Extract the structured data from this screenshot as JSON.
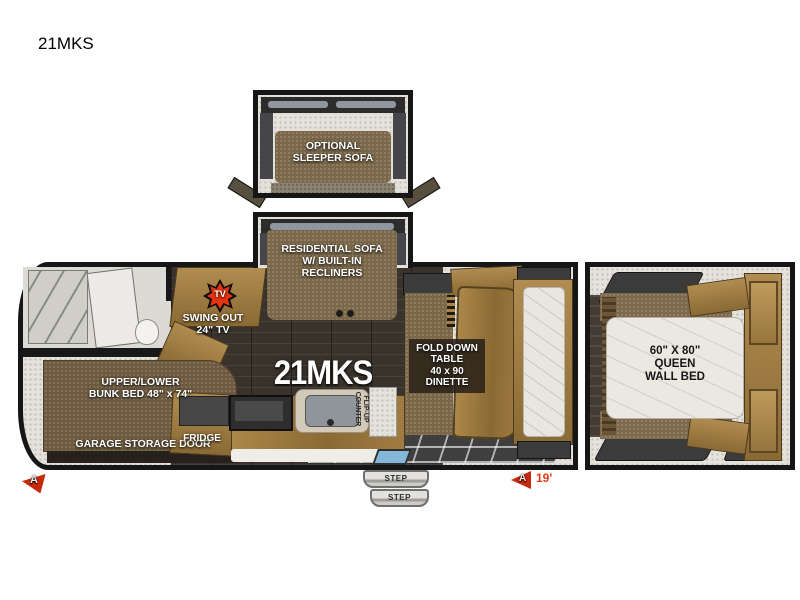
{
  "title": "21MKS",
  "colors": {
    "accent_red": "#c8290c",
    "cabinet_wood": "#9a7a42",
    "sofa_brown": "#7b684a",
    "dark_floor": "#39332b",
    "mattress": "#ebe8e2",
    "wall_black": "#161616"
  },
  "icons": {
    "tv_starburst": "red-starburst-badge",
    "front_marker": "red-arrowhead",
    "rear_marker": "red-arrowhead"
  },
  "labels": {
    "optional_sofa": "OPTIONAL\nSLEEPER SOFA",
    "residential_sofa": "RESIDENTIAL SOFA\nW/ BUILT-IN\nRECLINERS",
    "tv_badge": "TV",
    "swing_tv": "SWING OUT\n24\" TV",
    "floor_model": "21MKS",
    "dinette": "FOLD DOWN\nTABLE\n40 x 90\nDINETTE",
    "bunk_bed": "UPPER/LOWER\nBUNK BED 48\" x 74\"",
    "garage_door": "GARAGE STORAGE DOOR",
    "fridge": "FRIDGE",
    "flip_counter": "FLIP-UP\nCOUNTER",
    "queen_bed": "60\" X 80\"\nQUEEN\nWALL BED",
    "marker_front": "A",
    "marker_rear": "A",
    "length": "19'"
  },
  "steps": [
    "STEP",
    "STEP"
  ]
}
